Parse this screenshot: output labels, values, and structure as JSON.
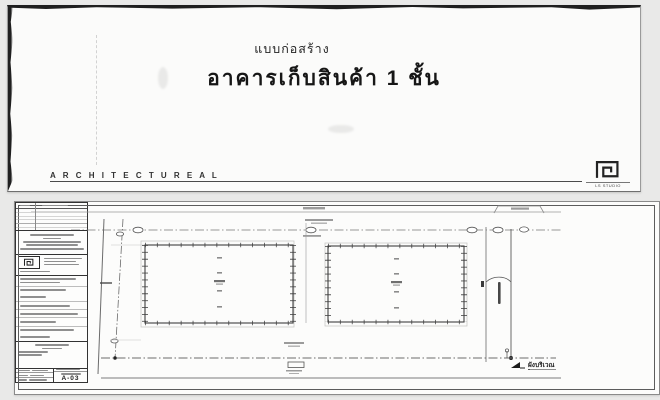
{
  "cover": {
    "subtitle": "แบบก่อสร้าง",
    "title": "อาคารเก็บสินค้า 1 ชั้น",
    "discipline": "A R C H I T E C T U R E A L",
    "studio_caption": "LS STUDIO"
  },
  "plan": {
    "caption": "ผังบริเวณ",
    "sheet_number": "A-03"
  },
  "colors": {
    "paper": "#fbfbfa",
    "ink": "#2b2b2b",
    "faint_text": "#8f8f8f"
  }
}
